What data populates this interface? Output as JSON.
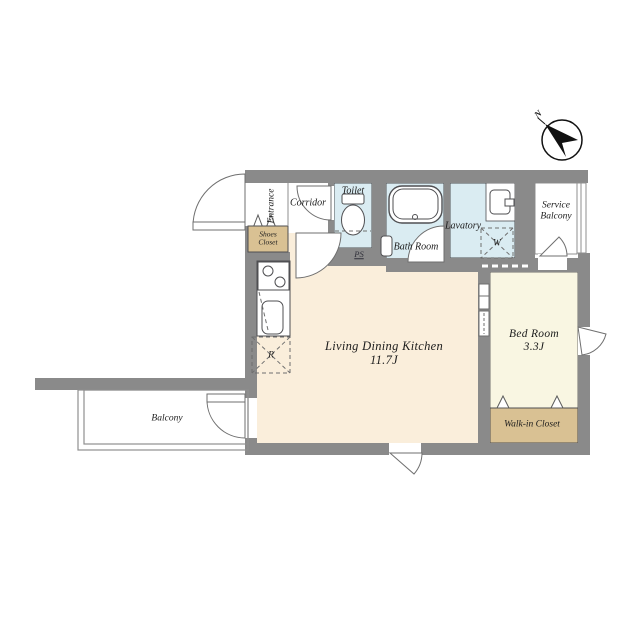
{
  "title": "apartment-floor-plan",
  "rooms": {
    "entrance": "Entrance",
    "corridor": "Corridor",
    "shoes_closet": {
      "line1": "Shoes",
      "line2": "Closet"
    },
    "toilet": "Toilet",
    "bath_room": "Bath Room",
    "lavatory": "Lavatory",
    "service_balcony": {
      "line1": "Service",
      "line2": "Balcony"
    },
    "ldk": {
      "name": "Living Dining Kitchen",
      "size": "11.7J"
    },
    "bed_room": {
      "name": "Bed Room",
      "size": "3.3J"
    },
    "walk_in_closet": "Walk-in Closet",
    "balcony": "Balcony"
  },
  "marks": {
    "washer": "W",
    "refrigerator": "R",
    "pipe_space": "PS",
    "compass_north": "N"
  },
  "colors": {
    "wall": "#8a8a8a",
    "ldk_floor": "#faeedb",
    "bedroom_floor": "#f9f6e2",
    "wet_area_floor": "#daecf2",
    "closet_fill": "#d9c193",
    "outline": "#4f4f52"
  }
}
